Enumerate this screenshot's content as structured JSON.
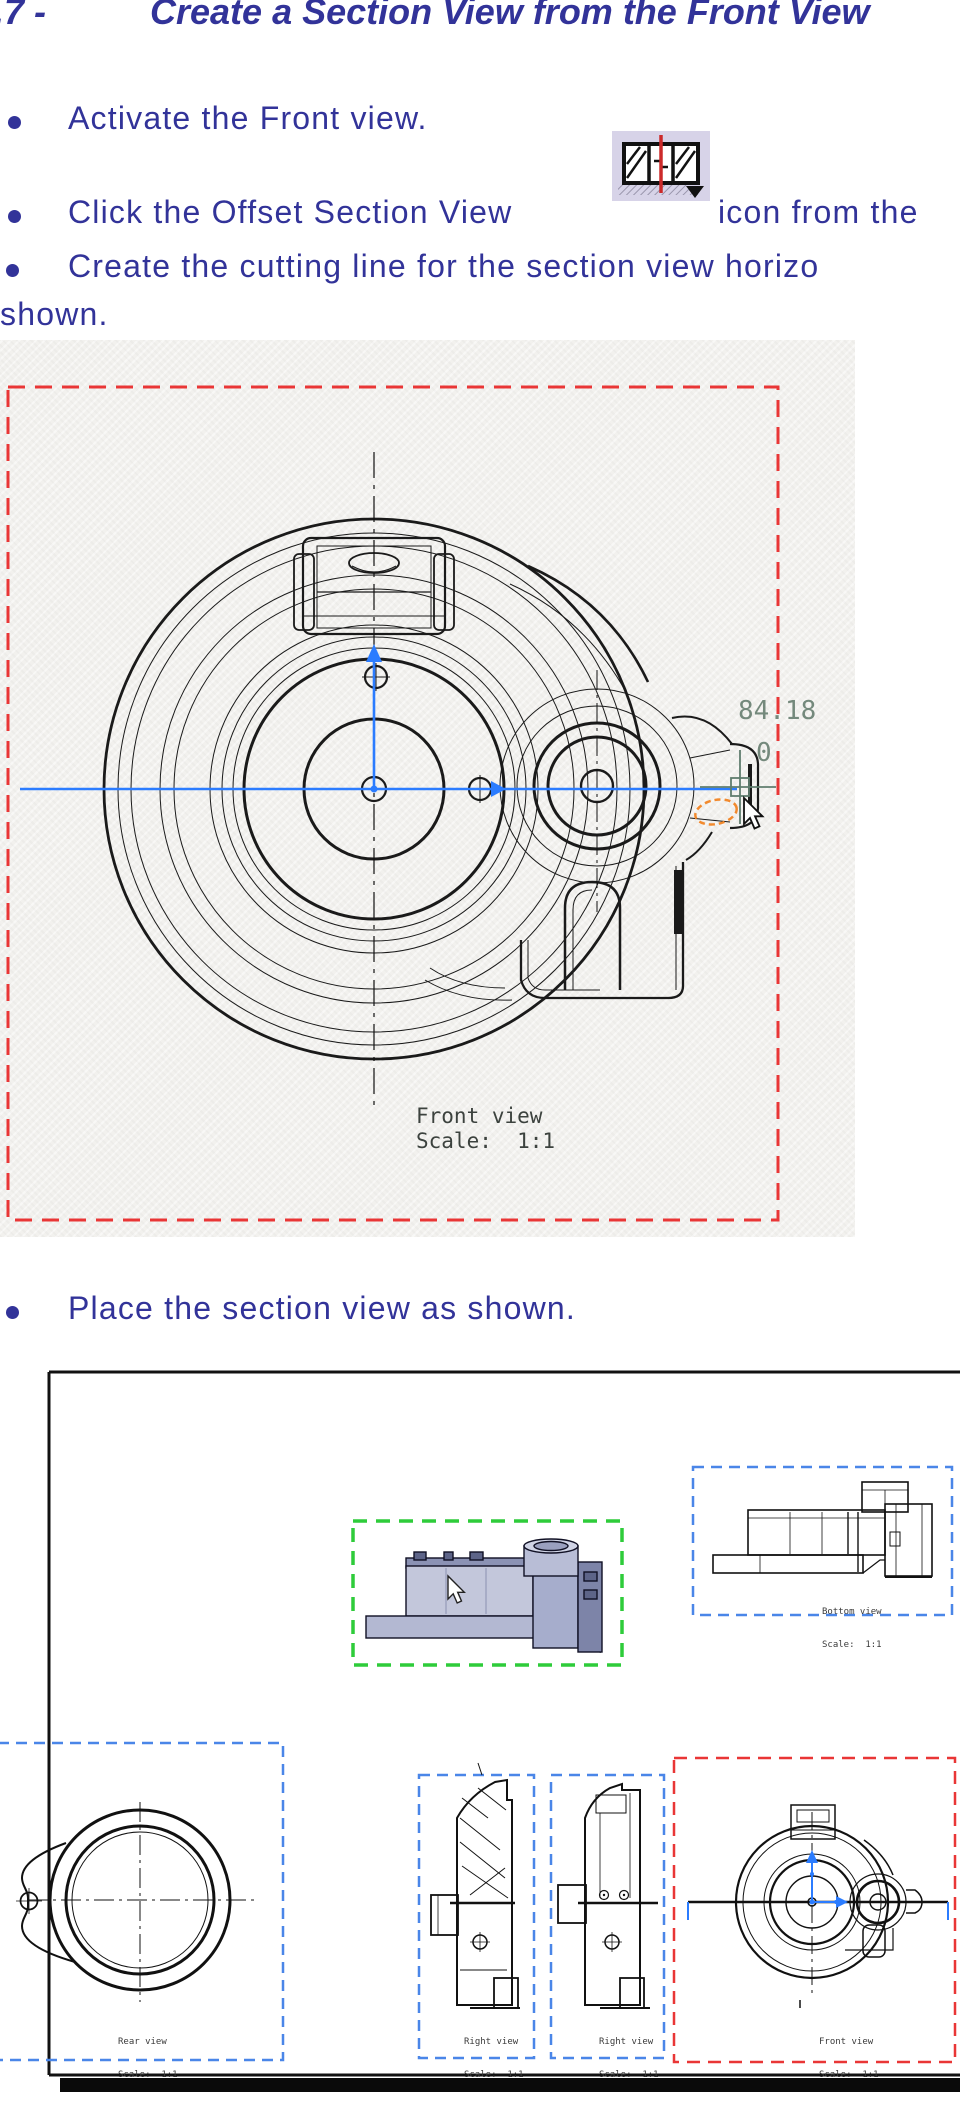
{
  "heading": {
    "prefix": ".7 -",
    "title": "Create a Section View from the Front View"
  },
  "bullets": {
    "activate": "Activate the Front view.",
    "click_pre": "Click the Offset Section View",
    "click_post": "icon from the",
    "create_line1": "Create the cutting line for the section view horizo",
    "create_line2": "shown.",
    "place": "Place the section view as shown."
  },
  "figure1": {
    "dim_offset": "84.18",
    "dim_zero": "0",
    "label_name": "Front view",
    "label_scale": "Scale:  1:1"
  },
  "figure2": {
    "bottom_view": {
      "name": "Bottom view",
      "scale": "Scale:  1:1"
    },
    "rear_view": {
      "name": "Rear view",
      "scale": "Scale:  1:1"
    },
    "right_view_1": {
      "name": "Right view",
      "scale": "Scale:  1:1"
    },
    "right_view_2": {
      "name": "Right view",
      "scale": "Scale:  1:1"
    },
    "front_view": {
      "name": "Front view",
      "scale": "Scale:  1:1"
    }
  },
  "colors": {
    "text_blue": "#323399",
    "red_dash": "#e93636",
    "blue_dash": "#4a86e8",
    "green_dash": "#2ecc3a",
    "cut_line_blue": "#2b7cff",
    "dim_green": "#74897c",
    "highlight_orange": "#f28a2e",
    "icon_bg": "#d7d3e8",
    "icon_red_line": "#cc2a2a"
  }
}
